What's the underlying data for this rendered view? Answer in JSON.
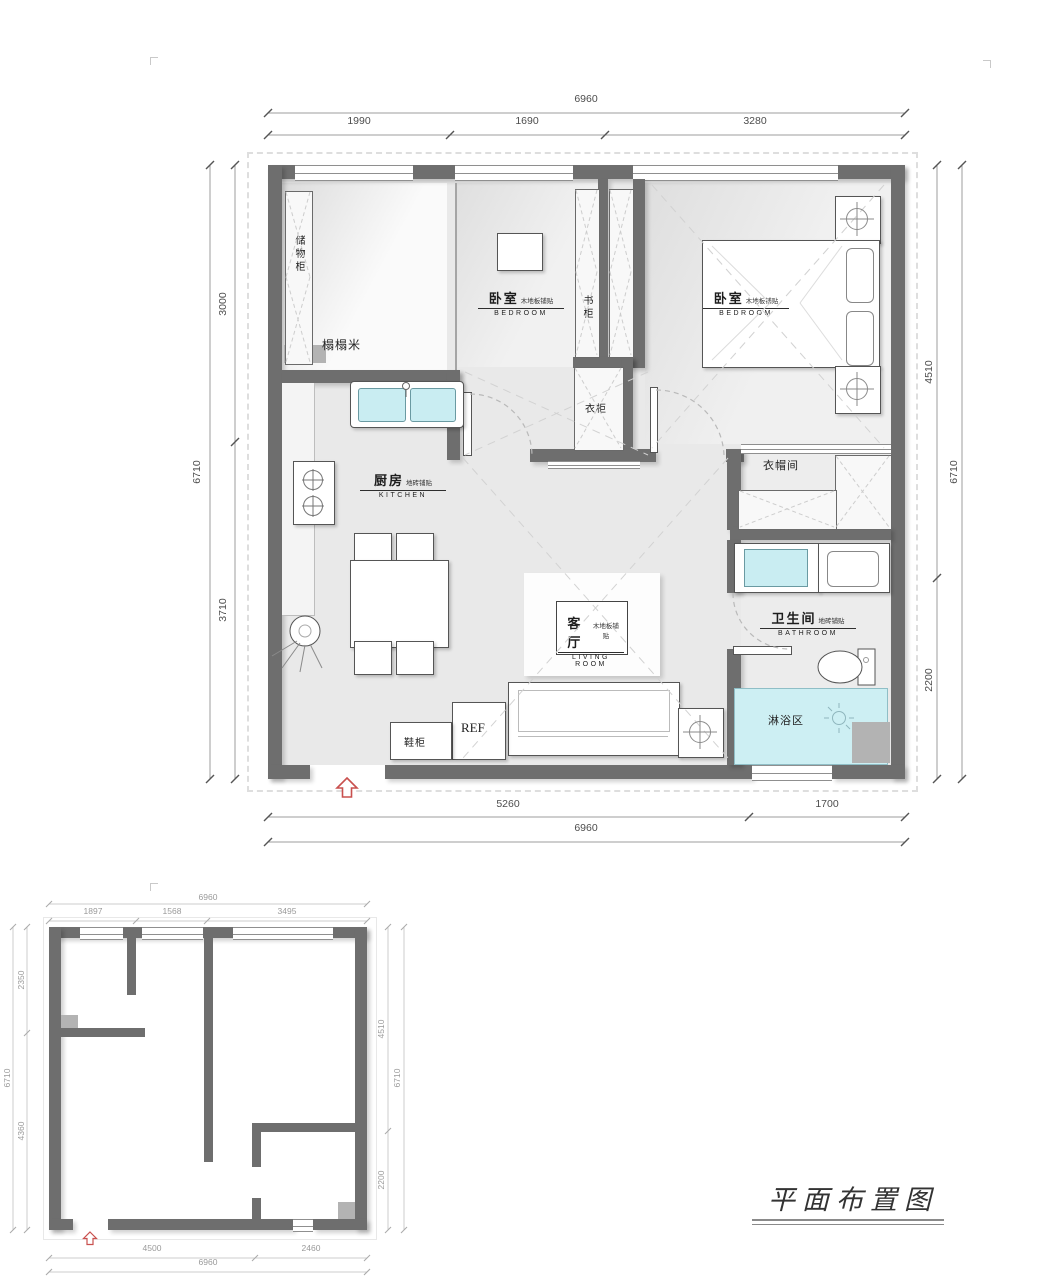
{
  "document": {
    "title": "平面布置图"
  },
  "colors": {
    "wall": "#6e6e6e",
    "water_fixture": "#c9edf2",
    "shower_floor": "#cdeff3",
    "entrance_arrow": "#c9504e",
    "hatch_line": "#cdcdcd",
    "dim_text": "#4d4d4d"
  },
  "furnished_plan": {
    "dims_top": {
      "total": "6960",
      "segments": [
        "1990",
        "1690",
        "3280"
      ]
    },
    "dims_bottom": {
      "total": "6960",
      "segments": [
        "5260",
        "1700"
      ]
    },
    "dims_left": {
      "total": "6710",
      "segments": [
        "3000",
        "3710"
      ]
    },
    "dims_right": {
      "total": "6710",
      "segments": [
        "4510",
        "2200"
      ]
    },
    "rooms": {
      "storage_cabinet": "储物柜",
      "tatami": "榻榻米",
      "bedroom_a": {
        "zh": "卧室",
        "note": "木地板铺贴",
        "en": "BEDROOM"
      },
      "bookcase": "书柜",
      "bedroom_b": {
        "zh": "卧室",
        "note": "木地板铺贴",
        "en": "BEDROOM"
      },
      "wardrobe": "衣柜",
      "cloakroom": "衣帽间",
      "kitchen": {
        "zh": "厨房",
        "note": "地砖铺贴",
        "en": "KITCHEN"
      },
      "living_room": {
        "zh": "客厅",
        "note": "木地板铺贴",
        "en": "LIVING ROOM"
      },
      "bathroom": {
        "zh": "卫生间",
        "note": "地砖铺贴",
        "en": "BATHROOM"
      },
      "shower_area": "淋浴区",
      "shoe_cabinet": "鞋柜",
      "fridge": "REF"
    }
  },
  "structural_plan": {
    "dims_top": {
      "total": "6960",
      "segments": [
        "1897",
        "1568",
        "3495"
      ]
    },
    "dims_bottom": {
      "total": "6960",
      "segments": [
        "4500",
        "2460"
      ]
    },
    "dims_left": {
      "total": "6710",
      "segments": [
        "2350",
        "4360"
      ]
    },
    "dims_right": {
      "total": "6710",
      "segments": [
        "4510",
        "2200"
      ]
    }
  }
}
